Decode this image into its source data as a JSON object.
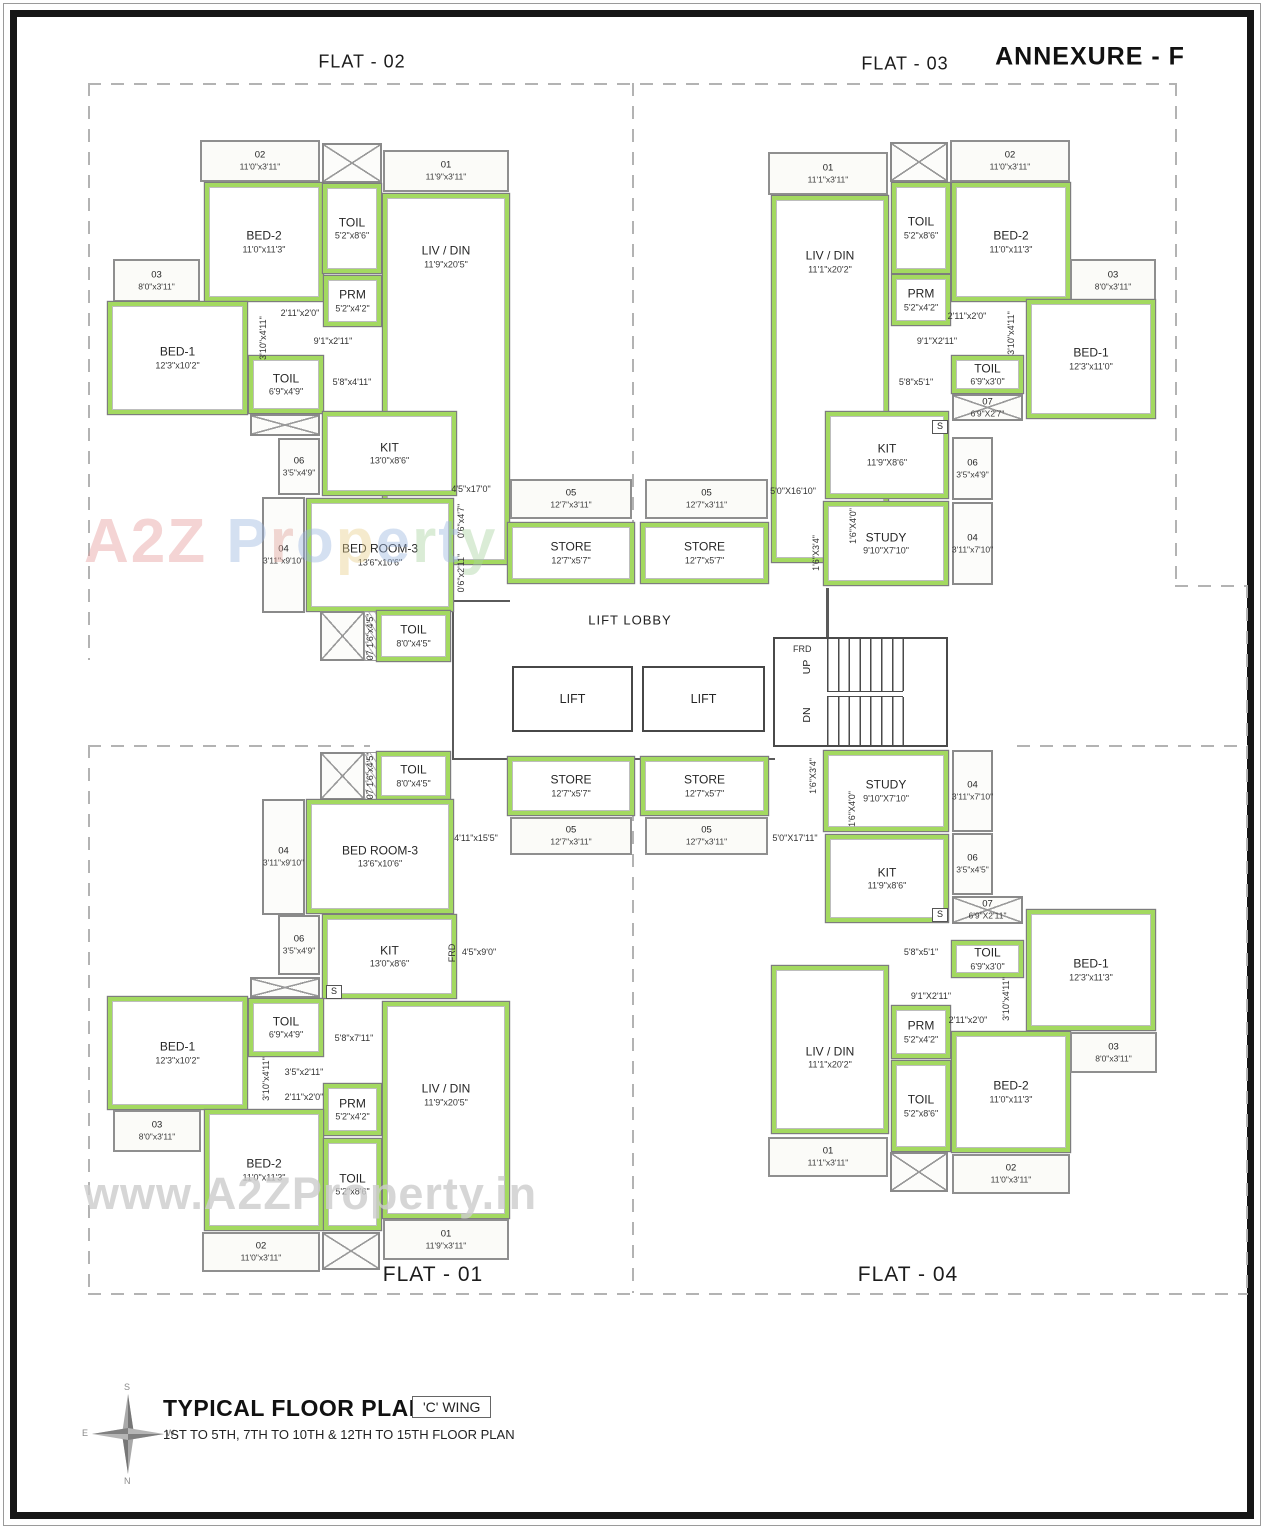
{
  "header": {
    "annexure": "ANNEXURE - F",
    "flat02": "FLAT - 02",
    "flat03": "FLAT - 03",
    "flat01": "FLAT - 01",
    "flat04": "FLAT - 04"
  },
  "core": {
    "lift_lobby": "LIFT LOBBY",
    "lift": "LIFT",
    "frd": "FRD",
    "up": "UP",
    "dn": "DN"
  },
  "watermark": {
    "big": "A2Z Property",
    "url": "www.A2ZProperty.in"
  },
  "titleblock": {
    "title": "TYPICAL FLOOR PLAN",
    "wing": "'C' WING",
    "subtitle": "1ST TO 5TH, 7TH TO 10TH & 12TH TO 15TH FLOOR PLAN",
    "compass": {
      "n": "N",
      "s": "S",
      "e": "E",
      "w": "W"
    }
  },
  "colors": {
    "wall_green": "#a3d960",
    "line_dark": "#555555",
    "line_mid": "#8a8a8a",
    "dash": "#b3b3b3"
  },
  "rooms": [
    {
      "flat": "flat-02",
      "t": "balc",
      "n": "02",
      "d": "11'0\"x3'11\"",
      "x": 200,
      "y": 140,
      "w": 120,
      "h": 42
    },
    {
      "flat": "flat-02",
      "t": "duct",
      "x": 322,
      "y": 143,
      "w": 60,
      "h": 40
    },
    {
      "flat": "flat-02",
      "t": "balc",
      "n": "01",
      "d": "11'9\"x3'11\"",
      "x": 383,
      "y": 150,
      "w": 126,
      "h": 42
    },
    {
      "flat": "flat-02",
      "t": "room",
      "n": "BED-2",
      "d": "11'0\"x11'3\"",
      "x": 205,
      "y": 183,
      "w": 118,
      "h": 118
    },
    {
      "flat": "flat-02",
      "t": "room",
      "n": "TOIL",
      "d": "5'2\"x8'6\"",
      "x": 323,
      "y": 184,
      "w": 58,
      "h": 89
    },
    {
      "flat": "flat-02",
      "t": "room",
      "n": "LIV / DIN",
      "d": "11'9\"x20'5\"",
      "x": 383,
      "y": 194,
      "w": 126,
      "h": 370,
      "ldy": -122
    },
    {
      "flat": "flat-02",
      "t": "room",
      "n": "PRM",
      "d": "5'2\"x4'2\"",
      "x": 324,
      "y": 276,
      "w": 57,
      "h": 50
    },
    {
      "flat": "flat-02",
      "t": "balc",
      "n": "03",
      "d": "8'0\"x3'11\"",
      "x": 113,
      "y": 259,
      "w": 87,
      "h": 43
    },
    {
      "flat": "flat-02",
      "t": "room",
      "n": "BED-1",
      "d": "12'3\"x10'2\"",
      "x": 108,
      "y": 302,
      "w": 139,
      "h": 112
    },
    {
      "flat": "flat-02",
      "t": "room",
      "n": "TOIL",
      "d": "6'9\"x4'9\"",
      "x": 249,
      "y": 356,
      "w": 74,
      "h": 57
    },
    {
      "flat": "flat-02",
      "t": "duct",
      "x": 250,
      "y": 414,
      "w": 70,
      "h": 22
    },
    {
      "flat": "flat-02",
      "t": "sbox",
      "n": "S",
      "x": 326,
      "y": 413,
      "w": 16,
      "h": 14
    },
    {
      "flat": "flat-02",
      "t": "room",
      "n": "KIT",
      "d": "13'0\"x8'6\"",
      "x": 323,
      "y": 412,
      "w": 133,
      "h": 83
    },
    {
      "flat": "flat-02",
      "t": "shaft",
      "n": "06",
      "d": "3'5\"x4'9\"",
      "x": 278,
      "y": 438,
      "w": 42,
      "h": 57
    },
    {
      "flat": "flat-02",
      "t": "shaft",
      "n": "04",
      "d": "3'11\"x9'10\"",
      "x": 262,
      "y": 497,
      "w": 43,
      "h": 116
    },
    {
      "flat": "flat-02",
      "t": "room",
      "n": "BED ROOM-3",
      "d": "13'6\"x10'6\"",
      "x": 307,
      "y": 499,
      "w": 146,
      "h": 112
    },
    {
      "flat": "flat-02",
      "t": "duct",
      "x": 320,
      "y": 611,
      "w": 45,
      "h": 50
    },
    {
      "flat": "flat-02",
      "t": "hatch",
      "x": 364,
      "y": 611,
      "w": 13,
      "h": 50
    },
    {
      "flat": "flat-02",
      "t": "room",
      "n": "TOIL",
      "d": "8'0\"x4'5\"",
      "x": 377,
      "y": 611,
      "w": 73,
      "h": 50
    },
    {
      "flat": "core",
      "t": "balc",
      "n": "05",
      "d": "12'7\"x3'11\"",
      "x": 510,
      "y": 479,
      "w": 122,
      "h": 40
    },
    {
      "flat": "core",
      "t": "balc",
      "n": "05",
      "d": "12'7\"x3'11\"",
      "x": 645,
      "y": 479,
      "w": 123,
      "h": 40
    },
    {
      "flat": "core",
      "t": "room",
      "n": "STORE",
      "d": "12'7\"x5'7\"",
      "x": 508,
      "y": 523,
      "w": 126,
      "h": 60
    },
    {
      "flat": "core",
      "t": "room",
      "n": "STORE",
      "d": "12'7\"x5'7\"",
      "x": 641,
      "y": 523,
      "w": 127,
      "h": 60
    },
    {
      "flat": "flat-03",
      "t": "balc",
      "n": "01",
      "d": "11'1\"x3'11\"",
      "x": 768,
      "y": 152,
      "w": 120,
      "h": 43
    },
    {
      "flat": "flat-03",
      "t": "duct",
      "x": 890,
      "y": 142,
      "w": 58,
      "h": 40
    },
    {
      "flat": "flat-03",
      "t": "balc",
      "n": "02",
      "d": "11'0\"x3'11\"",
      "x": 950,
      "y": 140,
      "w": 120,
      "h": 42
    },
    {
      "flat": "flat-03",
      "t": "room",
      "n": "LIV / DIN",
      "d": "11'1\"x20'2\"",
      "x": 772,
      "y": 196,
      "w": 116,
      "h": 366,
      "ldy": -117
    },
    {
      "flat": "flat-03",
      "t": "room",
      "n": "TOIL",
      "d": "5'2\"x8'6\"",
      "x": 892,
      "y": 183,
      "w": 58,
      "h": 90
    },
    {
      "flat": "flat-03",
      "t": "room",
      "n": "BED-2",
      "d": "11'0\"x11'3\"",
      "x": 952,
      "y": 183,
      "w": 118,
      "h": 118
    },
    {
      "flat": "flat-03",
      "t": "room",
      "n": "PRM",
      "d": "5'2\"x4'2\"",
      "x": 892,
      "y": 275,
      "w": 58,
      "h": 50
    },
    {
      "flat": "flat-03",
      "t": "balc",
      "n": "03",
      "d": "8'0\"x3'11\"",
      "x": 1070,
      "y": 259,
      "w": 86,
      "h": 43
    },
    {
      "flat": "flat-03",
      "t": "room",
      "n": "BED-1",
      "d": "12'3\"x11'0\"",
      "x": 1027,
      "y": 300,
      "w": 128,
      "h": 118
    },
    {
      "flat": "flat-03",
      "t": "room",
      "n": "TOIL",
      "d": "6'9\"x3'0\"",
      "x": 952,
      "y": 356,
      "w": 71,
      "h": 37
    },
    {
      "flat": "flat-03",
      "t": "duct",
      "n": "07",
      "d": "6'9\"X2'7\"",
      "x": 952,
      "y": 394,
      "w": 71,
      "h": 27
    },
    {
      "flat": "flat-03",
      "t": "room",
      "n": "KIT",
      "d": "11'9\"X8'6\"",
      "x": 826,
      "y": 412,
      "w": 122,
      "h": 86
    },
    {
      "flat": "flat-03",
      "t": "sbox",
      "n": "S",
      "x": 932,
      "y": 420,
      "w": 16,
      "h": 14
    },
    {
      "flat": "flat-03",
      "t": "shaft",
      "n": "06",
      "d": "3'5\"x4'9\"",
      "x": 952,
      "y": 437,
      "w": 41,
      "h": 63
    },
    {
      "flat": "flat-03",
      "t": "room",
      "n": "STUDY",
      "d": "9'10\"X7'10\"",
      "x": 824,
      "y": 502,
      "w": 124,
      "h": 83
    },
    {
      "flat": "flat-03",
      "t": "shaft",
      "n": "04",
      "d": "3'11\"x7'10\"",
      "x": 952,
      "y": 502,
      "w": 41,
      "h": 83
    },
    {
      "flat": "core",
      "t": "lift",
      "n": "LIFT",
      "x": 512,
      "y": 666,
      "w": 121,
      "h": 66
    },
    {
      "flat": "core",
      "t": "lift",
      "n": "LIFT",
      "x": 642,
      "y": 666,
      "w": 123,
      "h": 66
    },
    {
      "flat": "core",
      "t": "stair",
      "x": 773,
      "y": 637,
      "w": 175,
      "h": 110
    },
    {
      "flat": "core",
      "t": "room",
      "n": "STORE",
      "d": "12'7\"x5'7\"",
      "x": 508,
      "y": 757,
      "w": 126,
      "h": 58
    },
    {
      "flat": "core",
      "t": "room",
      "n": "STORE",
      "d": "12'7\"x5'7\"",
      "x": 641,
      "y": 757,
      "w": 127,
      "h": 58
    },
    {
      "flat": "core",
      "t": "balc",
      "n": "05",
      "d": "12'7\"x3'11\"",
      "x": 510,
      "y": 817,
      "w": 122,
      "h": 38
    },
    {
      "flat": "core",
      "t": "balc",
      "n": "05",
      "d": "12'7\"x3'11\"",
      "x": 645,
      "y": 817,
      "w": 123,
      "h": 38
    },
    {
      "flat": "flat-01",
      "t": "duct",
      "x": 320,
      "y": 752,
      "w": 45,
      "h": 48
    },
    {
      "flat": "flat-01",
      "t": "hatch",
      "x": 364,
      "y": 752,
      "w": 13,
      "h": 48
    },
    {
      "flat": "flat-01",
      "t": "room",
      "n": "TOIL",
      "d": "8'0\"x4'5\"",
      "x": 377,
      "y": 752,
      "w": 73,
      "h": 48
    },
    {
      "flat": "flat-01",
      "t": "shaft",
      "n": "04",
      "d": "3'11\"x9'10\"",
      "x": 262,
      "y": 799,
      "w": 43,
      "h": 116
    },
    {
      "flat": "flat-01",
      "t": "room",
      "n": "BED ROOM-3",
      "d": "13'6\"x10'6\"",
      "x": 307,
      "y": 800,
      "w": 146,
      "h": 113
    },
    {
      "flat": "flat-01",
      "t": "room",
      "n": "KIT",
      "d": "13'0\"x8'6\"",
      "x": 323,
      "y": 915,
      "w": 133,
      "h": 83
    },
    {
      "flat": "flat-01",
      "t": "shaft",
      "n": "06",
      "d": "3'5\"x4'9\"",
      "x": 278,
      "y": 915,
      "w": 42,
      "h": 60
    },
    {
      "flat": "flat-01",
      "t": "duct",
      "x": 250,
      "y": 977,
      "w": 70,
      "h": 21
    },
    {
      "flat": "flat-01",
      "t": "sbox",
      "n": "S",
      "x": 326,
      "y": 985,
      "w": 16,
      "h": 14
    },
    {
      "flat": "flat-01",
      "t": "room",
      "n": "TOIL",
      "d": "6'9\"x4'9\"",
      "x": 249,
      "y": 999,
      "w": 74,
      "h": 57
    },
    {
      "flat": "flat-01",
      "t": "room",
      "n": "BED-1",
      "d": "12'3\"x10'2\"",
      "x": 108,
      "y": 997,
      "w": 139,
      "h": 112
    },
    {
      "flat": "flat-01",
      "t": "room",
      "n": "LIV / DIN",
      "d": "11'9\"x20'5\"",
      "x": 383,
      "y": 1002,
      "w": 126,
      "h": 216,
      "ldy": -15
    },
    {
      "flat": "flat-01",
      "t": "room",
      "n": "PRM",
      "d": "5'2\"x4'2\"",
      "x": 324,
      "y": 1084,
      "w": 57,
      "h": 51
    },
    {
      "flat": "flat-01",
      "t": "balc",
      "n": "03",
      "d": "8'0\"x3'11\"",
      "x": 113,
      "y": 1110,
      "w": 88,
      "h": 42
    },
    {
      "flat": "flat-01",
      "t": "room",
      "n": "BED-2",
      "d": "11'0\"x11'3\"",
      "x": 205,
      "y": 1110,
      "w": 118,
      "h": 120
    },
    {
      "flat": "flat-01",
      "t": "room",
      "n": "TOIL",
      "d": "5'2\"x8'6\"",
      "x": 324,
      "y": 1139,
      "w": 57,
      "h": 91
    },
    {
      "flat": "flat-01",
      "t": "balc",
      "n": "02",
      "d": "11'0\"x3'11\"",
      "x": 202,
      "y": 1232,
      "w": 118,
      "h": 40
    },
    {
      "flat": "flat-01",
      "t": "duct",
      "x": 322,
      "y": 1232,
      "w": 58,
      "h": 38
    },
    {
      "flat": "flat-01",
      "t": "balc",
      "n": "01",
      "d": "11'9\"x3'11\"",
      "x": 383,
      "y": 1219,
      "w": 126,
      "h": 41
    },
    {
      "flat": "flat-04",
      "t": "room",
      "n": "STUDY",
      "d": "9'10\"X7'10\"",
      "x": 824,
      "y": 751,
      "w": 124,
      "h": 80
    },
    {
      "flat": "flat-04",
      "t": "shaft",
      "n": "04",
      "d": "3'11\"x7'10\"",
      "x": 952,
      "y": 750,
      "w": 41,
      "h": 82
    },
    {
      "flat": "flat-04",
      "t": "shaft",
      "n": "06",
      "d": "3'5\"x4'5\"",
      "x": 952,
      "y": 833,
      "w": 41,
      "h": 62
    },
    {
      "flat": "flat-04",
      "t": "room",
      "n": "KIT",
      "d": "11'9\"x8'6\"",
      "x": 826,
      "y": 835,
      "w": 122,
      "h": 87
    },
    {
      "flat": "flat-04",
      "t": "sbox",
      "n": "S",
      "x": 932,
      "y": 908,
      "w": 16,
      "h": 14
    },
    {
      "flat": "flat-04",
      "t": "duct",
      "n": "07",
      "d": "6'9\"X2'11\"",
      "x": 952,
      "y": 896,
      "w": 71,
      "h": 28
    },
    {
      "flat": "flat-04",
      "t": "room",
      "n": "TOIL",
      "d": "6'9\"x3'0\"",
      "x": 952,
      "y": 941,
      "w": 71,
      "h": 36
    },
    {
      "flat": "flat-04",
      "t": "room",
      "n": "BED-1",
      "d": "12'3\"x11'3\"",
      "x": 1027,
      "y": 910,
      "w": 128,
      "h": 120
    },
    {
      "flat": "flat-04",
      "t": "room",
      "n": "PRM",
      "d": "5'2\"x4'2\"",
      "x": 892,
      "y": 1006,
      "w": 58,
      "h": 52
    },
    {
      "flat": "flat-04",
      "t": "room",
      "n": "LIV / DIN",
      "d": "11'1\"x20'2\"",
      "x": 772,
      "y": 966,
      "w": 116,
      "h": 167,
      "ldy": 8
    },
    {
      "flat": "flat-04",
      "t": "room",
      "n": "TOIL",
      "d": "5'2\"x8'6\"",
      "x": 892,
      "y": 1061,
      "w": 58,
      "h": 90
    },
    {
      "flat": "flat-04",
      "t": "room",
      "n": "BED-2",
      "d": "11'0\"x11'3\"",
      "x": 952,
      "y": 1032,
      "w": 118,
      "h": 120
    },
    {
      "flat": "flat-04",
      "t": "balc",
      "n": "03",
      "d": "8'0\"x3'11\"",
      "x": 1070,
      "y": 1032,
      "w": 87,
      "h": 41
    },
    {
      "flat": "flat-04",
      "t": "balc",
      "n": "01",
      "d": "11'1\"x3'11\"",
      "x": 768,
      "y": 1137,
      "w": 120,
      "h": 40
    },
    {
      "flat": "flat-04",
      "t": "duct",
      "x": 890,
      "y": 1152,
      "w": 58,
      "h": 40
    },
    {
      "flat": "flat-04",
      "t": "balc",
      "n": "02",
      "d": "11'0\"x3'11\"",
      "x": 952,
      "y": 1154,
      "w": 118,
      "h": 40
    }
  ],
  "dims": [
    {
      "t": "2'11\"x2'0\"",
      "x": 300,
      "y": 313
    },
    {
      "t": "9'1\"x2'11\"",
      "x": 333,
      "y": 341
    },
    {
      "t": "3'10\"x4'11\"",
      "x": 263,
      "y": 338,
      "rot": 1
    },
    {
      "t": "5'8\"x4'11\"",
      "x": 352,
      "y": 382
    },
    {
      "t": "4'5\"x17'0\"",
      "x": 471,
      "y": 489
    },
    {
      "t": "0'6\"x4'7\"",
      "x": 461,
      "y": 521,
      "rot": 1
    },
    {
      "t": "0'6\"x2'11\"",
      "x": 461,
      "y": 573,
      "rot": 1
    },
    {
      "t": "07  1'6\"x4'5\"",
      "x": 370,
      "y": 637,
      "rot": 1
    },
    {
      "t": "2'11\"x2'0\"",
      "x": 967,
      "y": 316
    },
    {
      "t": "9'1\"X2'11\"",
      "x": 937,
      "y": 341
    },
    {
      "t": "3'10\"x4'11\"",
      "x": 1011,
      "y": 333,
      "rot": 1
    },
    {
      "t": "5'8\"x5'1\"",
      "x": 916,
      "y": 382
    },
    {
      "t": "5'0\"X16'10\"",
      "x": 793,
      "y": 491
    },
    {
      "t": "1'6\"X4'0\"",
      "x": 853,
      "y": 526,
      "rot": 1
    },
    {
      "t": "1'6\"X3'4\"",
      "x": 816,
      "y": 553,
      "rot": 1
    },
    {
      "t": "4'11\"x15'5\"",
      "x": 476,
      "y": 838
    },
    {
      "t": "5'0\"X17'11\"",
      "x": 795,
      "y": 838
    },
    {
      "t": "1'6\"X3'4\"",
      "x": 813,
      "y": 776,
      "rot": 1
    },
    {
      "t": "1'6\"X4'0\"",
      "x": 852,
      "y": 809,
      "rot": 1
    },
    {
      "t": "07  1'6\"x4'5\"",
      "x": 370,
      "y": 776,
      "rot": 1
    },
    {
      "t": "4'5\"x9'0\"",
      "x": 479,
      "y": 952
    },
    {
      "t": "FRD",
      "x": 452,
      "y": 953,
      "rot": 1
    },
    {
      "t": "5'8\"x7'11\"",
      "x": 354,
      "y": 1038
    },
    {
      "t": "3'5\"x2'11\"",
      "x": 304,
      "y": 1072
    },
    {
      "t": "2'11\"x2'0\"",
      "x": 304,
      "y": 1097
    },
    {
      "t": "3'10\"x4'11\"",
      "x": 266,
      "y": 1079,
      "rot": 1
    },
    {
      "t": "5'8\"x5'1\"",
      "x": 921,
      "y": 952
    },
    {
      "t": "9'1\"X2'11\"",
      "x": 931,
      "y": 996
    },
    {
      "t": "2'11\"x2'0\"",
      "x": 968,
      "y": 1020
    },
    {
      "t": "3'10\"x4'11\"",
      "x": 1006,
      "y": 999,
      "rot": 1
    },
    {
      "t": "LIFT LOBBY",
      "x": 630,
      "y": 620,
      "big": 1
    }
  ]
}
